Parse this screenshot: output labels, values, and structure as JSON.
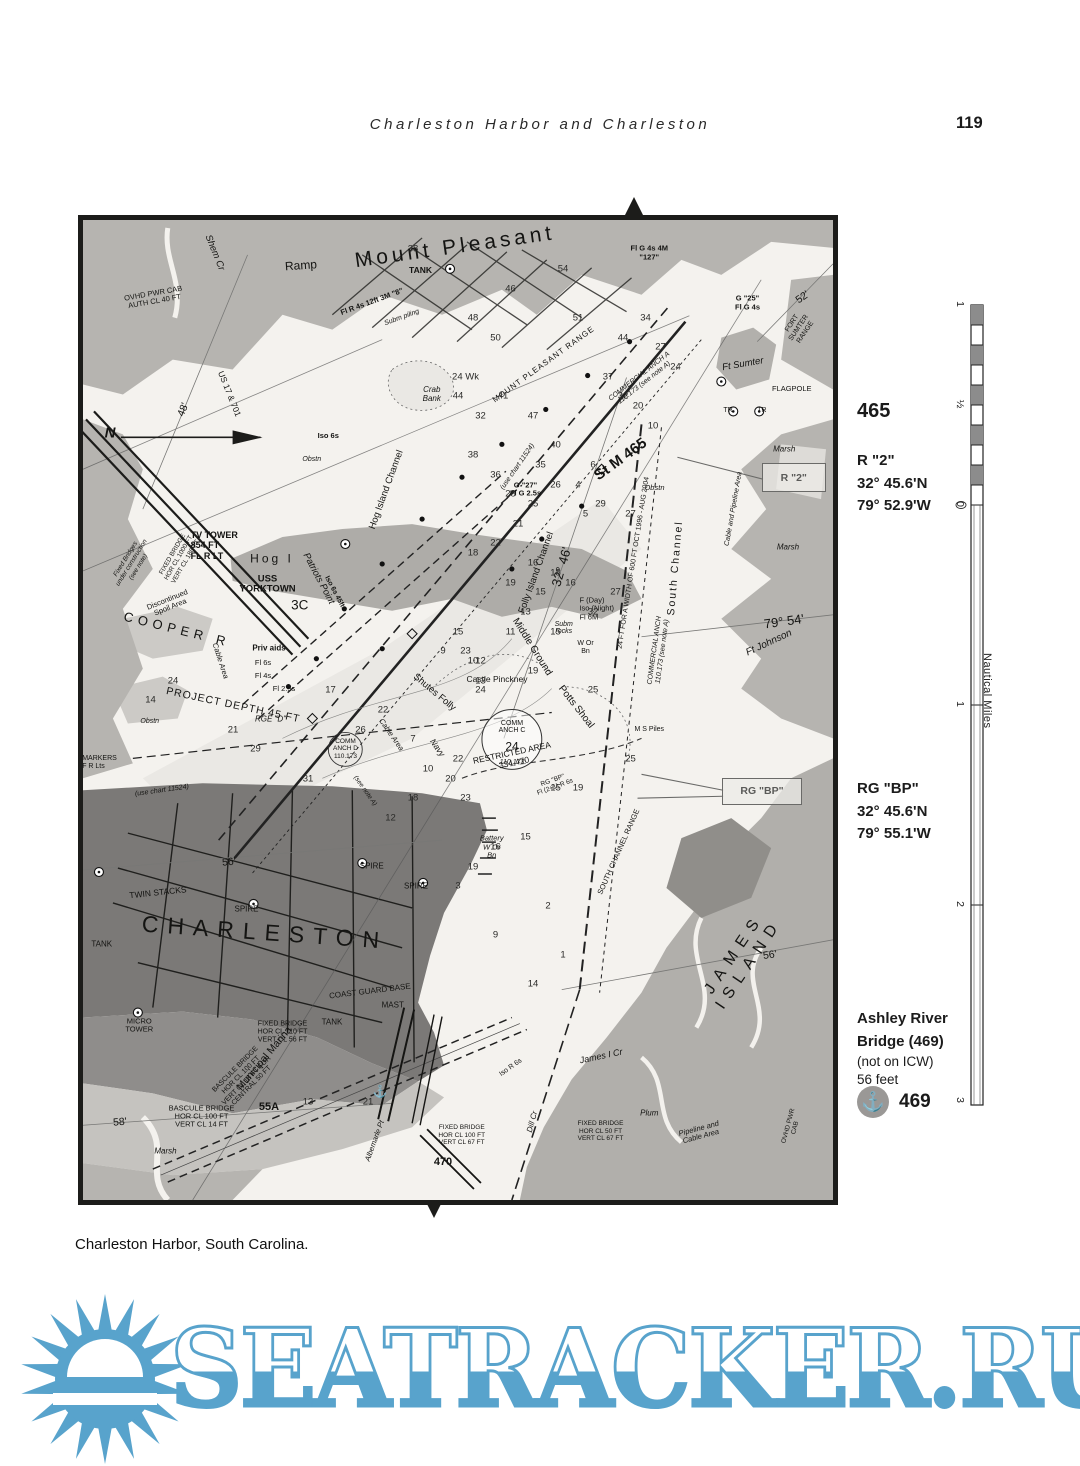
{
  "page": {
    "header_title": "Charleston Harbor and Charleston",
    "page_number": "119",
    "caption": "Charleston Harbor, South Carolina."
  },
  "sidebar": {
    "mile_number": "465",
    "r2": {
      "name": "R \"2\"",
      "lat": "32° 45.6'N",
      "lon": "79° 52.9'W"
    },
    "rgbp": {
      "name": "RG \"BP\"",
      "lat": "32° 45.6'N",
      "lon": "79° 55.1'W"
    },
    "bridge": {
      "line1": "Ashley River",
      "line2": "Bridge (469)",
      "note": "(not on ICW)",
      "height": "56 feet",
      "anchor_number": "469",
      "anchor_icon": "⚓"
    },
    "scale": {
      "title": "Nautical Miles",
      "ticks": [
        {
          "label": "1",
          "y": 10
        },
        {
          "label": "½",
          "y": 110
        },
        {
          "label": "0",
          "y": 210
        },
        {
          "label": "1",
          "y": 410
        },
        {
          "label": "2",
          "y": 610
        },
        {
          "label": "3",
          "y": 806
        }
      ]
    }
  },
  "map": {
    "callouts": [
      {
        "text": "R \"2\""
      },
      {
        "text": "RG \"BP\""
      }
    ],
    "labels": [
      {
        "t": "Mount Pleasant",
        "x": 49.6,
        "y": 2.8,
        "r": -8,
        "s": 21,
        "sp": 4,
        "w": 500,
        "n": "label-mount-pleasant"
      },
      {
        "t": "Ramp",
        "x": 29,
        "y": 4.7,
        "s": 12,
        "r": -4
      },
      {
        "t": "TANK",
        "x": 45,
        "y": 5.2,
        "s": 8.5,
        "w": 600
      },
      {
        "t": "Shem Cr",
        "x": 17.5,
        "y": 3.4,
        "r": 68,
        "s": 9.5,
        "i": 1
      },
      {
        "t": "OVHD PWR CAB\nAUTH CL 40 FT",
        "x": 9.5,
        "y": 8,
        "r": -10,
        "s": 7.5
      },
      {
        "t": "Fl R 4s 12ft 3M \"8\"",
        "x": 38.6,
        "y": 8.4,
        "r": -20,
        "s": 7.5,
        "w": 600
      },
      {
        "t": "Subm piling",
        "x": 42.5,
        "y": 10,
        "r": -20,
        "s": 7,
        "i": 1
      },
      {
        "t": "Fl G 4s 4M\n\"127\"",
        "x": 75.5,
        "y": 3.4,
        "s": 7.5,
        "w": 600
      },
      {
        "t": "52'",
        "x": 96,
        "y": 8,
        "r": -35,
        "s": 10.5
      },
      {
        "t": "G \"25\"\nFl G 4s",
        "x": 88.6,
        "y": 8.5,
        "s": 7.5,
        "w": 600
      },
      {
        "t": "MOUNT PLEASANT RANGE",
        "x": 61.5,
        "y": 14.8,
        "r": -36,
        "s": 8,
        "sp": 1
      },
      {
        "t": "COMMERCIAL ANCH A\n110.173 (see note A)",
        "x": 74.5,
        "y": 16.3,
        "r": -38,
        "s": 7,
        "i": 1
      },
      {
        "t": "FORT SUMTER RANGE",
        "x": 95.5,
        "y": 11,
        "r": -56,
        "s": 7
      },
      {
        "t": "Ft Sumter",
        "x": 88,
        "y": 14.8,
        "r": -10,
        "s": 9.5,
        "i": 1
      },
      {
        "t": "FLAGPOLE",
        "x": 94.5,
        "y": 17.2,
        "s": 7.5
      },
      {
        "t": "TR",
        "x": 86,
        "y": 19.5,
        "s": 7
      },
      {
        "t": "TR",
        "x": 90.5,
        "y": 19.5,
        "s": 7
      },
      {
        "t": "Crab\nBank",
        "x": 46.5,
        "y": 17.9,
        "s": 8,
        "i": 1
      },
      {
        "t": "48'",
        "x": 13.4,
        "y": 19.4,
        "r": -68,
        "s": 10.5
      },
      {
        "t": "N",
        "x": 3.6,
        "y": 21.8,
        "s": 15,
        "w": 700,
        "i": 1
      },
      {
        "t": "US 17 & 701",
        "x": 19.5,
        "y": 17.8,
        "r": 68,
        "s": 8.5
      },
      {
        "t": "Iso 6s",
        "x": 32.7,
        "y": 22,
        "s": 7.5,
        "w": 600
      },
      {
        "t": "Obstn",
        "x": 30.5,
        "y": 24.5,
        "s": 7,
        "i": 1
      },
      {
        "t": "(use chart 11524)",
        "x": 58,
        "y": 25.2,
        "r": -55,
        "s": 7,
        "i": 1
      },
      {
        "t": "St M 465",
        "x": 71.7,
        "y": 24.5,
        "r": -36,
        "s": 15,
        "w": 700,
        "n": "label-st-m-465"
      },
      {
        "t": "G \"27\"\nFl G 2.5s",
        "x": 59,
        "y": 27.5,
        "s": 7.5,
        "w": 600
      },
      {
        "t": "Obstn",
        "x": 76.2,
        "y": 27.3,
        "s": 7.5,
        "i": 1
      },
      {
        "t": "TV TOWER\n854 FT\nFL R LT",
        "x": 17.5,
        "y": 33.2,
        "s": 9,
        "w": 600,
        "a": "left"
      },
      {
        "t": "Fixed Bridges\nunder construction\n(see note)",
        "x": 6.5,
        "y": 35,
        "r": -58,
        "s": 6.5,
        "i": 1
      },
      {
        "t": "FIXED BRIDGE\nHOR CL 1000 FT\nVERT CL 186 FT",
        "x": 12.8,
        "y": 34.5,
        "r": -60,
        "s": 6.5
      },
      {
        "t": "Hog I",
        "x": 25.2,
        "y": 34.6,
        "s": 12,
        "sp": 3
      },
      {
        "t": "Patriots Point",
        "x": 31.3,
        "y": 36.6,
        "r": 62,
        "s": 9.5,
        "i": 1
      },
      {
        "t": "Iso 6s 45ft",
        "x": 33.5,
        "y": 38,
        "r": 62,
        "s": 7,
        "w": 600
      },
      {
        "t": "USS\nYORKTOWN",
        "x": 24.6,
        "y": 37.2,
        "s": 9.5,
        "w": 600
      },
      {
        "t": "3C",
        "x": 28.9,
        "y": 39.3,
        "s": 13.5
      },
      {
        "t": "32° 46'",
        "x": 63.8,
        "y": 35.4,
        "r": -74,
        "s": 13
      },
      {
        "t": "Folly Island Channel",
        "x": 60.5,
        "y": 36,
        "r": -70,
        "s": 9.5
      },
      {
        "t": "Hog Island Channel",
        "x": 40.5,
        "y": 27.5,
        "r": -70,
        "s": 9.5
      },
      {
        "t": "South Channel",
        "x": 79,
        "y": 35.5,
        "r": -85,
        "s": 10.5,
        "sp": 2
      },
      {
        "t": "24 FT FOR A WIDTH OF 600 FT OCT 1996 - AUG 2004",
        "x": 73.5,
        "y": 35,
        "r": -81,
        "s": 7
      },
      {
        "t": "COMMERCIAL ANCH\n110.173 (see note A)",
        "x": 76.8,
        "y": 44,
        "r": -82,
        "s": 7,
        "i": 1
      },
      {
        "t": "Cable and Pipeline Area",
        "x": 86.8,
        "y": 29.5,
        "r": -80,
        "s": 7,
        "i": 1
      },
      {
        "t": "Marsh",
        "x": 93.5,
        "y": 23.5,
        "s": 8,
        "i": 1
      },
      {
        "t": "Marsh",
        "x": 94,
        "y": 33.5,
        "s": 8,
        "i": 1
      },
      {
        "t": "79° 54'",
        "x": 93.5,
        "y": 41,
        "r": -8,
        "s": 13
      },
      {
        "t": "Ft Johnson",
        "x": 91.5,
        "y": 43.2,
        "r": -25,
        "s": 10,
        "i": 1
      },
      {
        "t": "COOPER R",
        "x": 12.5,
        "y": 41.8,
        "r": 14,
        "s": 13,
        "sp": 5,
        "n": "label-cooper-river"
      },
      {
        "t": "Discontinued\nSpoil Area",
        "x": 11.5,
        "y": 39.2,
        "r": -22,
        "s": 7.5
      },
      {
        "t": "Priv aids",
        "x": 24.8,
        "y": 43.8,
        "s": 8,
        "w": 600
      },
      {
        "t": "Fl 6s",
        "x": 24,
        "y": 45.2,
        "s": 7.5
      },
      {
        "t": "Fl 4s",
        "x": 24,
        "y": 46.5,
        "s": 7.5
      },
      {
        "t": "Fl 2.5s",
        "x": 26.8,
        "y": 47.9,
        "s": 7.5
      },
      {
        "t": "Cable Area",
        "x": 18.2,
        "y": 45,
        "r": 72,
        "s": 7.5,
        "i": 1
      },
      {
        "t": "PROJECT DEPTH 45 FT",
        "x": 20,
        "y": 49.6,
        "r": 12,
        "s": 10.5,
        "sp": 1
      },
      {
        "t": "RGE \"D\"",
        "x": 25,
        "y": 51,
        "s": 8,
        "i": 1
      },
      {
        "t": "Cable Area",
        "x": 41,
        "y": 52.5,
        "r": 55,
        "s": 7.5,
        "i": 1
      },
      {
        "t": "(use chart 11524)",
        "x": 10.5,
        "y": 58.3,
        "r": -8,
        "s": 7,
        "i": 1
      },
      {
        "t": "MARKERS\nF R Lts",
        "x": 2.2,
        "y": 55.4,
        "s": 7,
        "a": "left"
      },
      {
        "t": "Obstn",
        "x": 8.9,
        "y": 51.2,
        "s": 7,
        "i": 1
      },
      {
        "t": "Shutes Folly",
        "x": 46.8,
        "y": 48.3,
        "r": 40,
        "s": 9.5
      },
      {
        "t": "Castle Pinckney",
        "x": 55.2,
        "y": 46.9,
        "s": 8.5
      },
      {
        "t": "Middle Ground",
        "x": 59.8,
        "y": 43.6,
        "r": 58,
        "s": 10
      },
      {
        "t": "Subm\nrocks",
        "x": 64.1,
        "y": 41.7,
        "s": 7,
        "i": 1
      },
      {
        "t": "F (Day)\nIso (Night)\nFl 6M",
        "x": 68.5,
        "y": 39.7,
        "s": 7.5,
        "a": "left"
      },
      {
        "t": "W Or\nBn",
        "x": 67,
        "y": 43.7,
        "s": 7
      },
      {
        "t": "Potts Shoal",
        "x": 65.7,
        "y": 49.7,
        "r": 52,
        "s": 10
      },
      {
        "t": "COMM\nANCH C",
        "x": 57.2,
        "y": 51.8,
        "s": 7
      },
      {
        "t": "24",
        "x": 57.2,
        "y": 53.8,
        "s": 12
      },
      {
        "t": "110.173",
        "x": 57.2,
        "y": 55.4,
        "s": 7,
        "i": 1
      },
      {
        "t": "COMM\nANCH D\n110.173",
        "x": 35,
        "y": 54,
        "s": 6.5
      },
      {
        "t": "(see note A)",
        "x": 37.6,
        "y": 58.3,
        "r": 55,
        "s": 6.5,
        "i": 1
      },
      {
        "t": "Navy",
        "x": 47.2,
        "y": 53.9,
        "r": 55,
        "s": 8.5,
        "i": 1
      },
      {
        "t": "RESTRICTED AREA\n334.470",
        "x": 57.3,
        "y": 54.9,
        "r": -12,
        "s": 8.5
      },
      {
        "t": "RG \"BP\"\nFl (2+1) R 6s",
        "x": 62.8,
        "y": 57.6,
        "r": -20,
        "s": 6.5
      },
      {
        "t": "M S Piles",
        "x": 75.5,
        "y": 52,
        "s": 7
      },
      {
        "t": "SOUTH CHANNEL RANGE",
        "x": 71.5,
        "y": 64.5,
        "r": -66,
        "s": 7.5
      },
      {
        "t": "Battery\nW Or\nBn",
        "x": 54.5,
        "y": 64,
        "s": 7.5,
        "i": 1
      },
      {
        "t": "56'",
        "x": 19.5,
        "y": 65.6,
        "r": -5,
        "s": 10.5
      },
      {
        "t": "TWIN STACKS",
        "x": 10,
        "y": 68.7,
        "r": -6,
        "s": 8.5
      },
      {
        "t": "SPIRE",
        "x": 21.8,
        "y": 70.4,
        "s": 8
      },
      {
        "t": "SPIRE",
        "x": 38.5,
        "y": 66,
        "s": 8
      },
      {
        "t": "SPIRE",
        "x": 44.4,
        "y": 68.1,
        "s": 8
      },
      {
        "t": "CHARLESTON",
        "x": 24.2,
        "y": 72.8,
        "r": 4,
        "s": 23,
        "sp": 9,
        "n": "label-charleston"
      },
      {
        "t": "TANK",
        "x": 2.5,
        "y": 74,
        "s": 8
      },
      {
        "t": "COAST GUARD BASE",
        "x": 38.2,
        "y": 78.8,
        "r": -7,
        "s": 8
      },
      {
        "t": "MAST",
        "x": 41.3,
        "y": 80.2,
        "s": 8
      },
      {
        "t": "JAMES ISLAND",
        "x": 87.8,
        "y": 75.4,
        "r": -56,
        "s": 16,
        "sp": 8,
        "n": "label-james-island"
      },
      {
        "t": "56'",
        "x": 91.6,
        "y": 75.1,
        "r": -8,
        "s": 10.5
      },
      {
        "t": "James I Cr",
        "x": 69,
        "y": 85.3,
        "r": -12,
        "s": 9,
        "i": 1
      },
      {
        "t": "Plum",
        "x": 75.5,
        "y": 91.2,
        "s": 8,
        "i": 1
      },
      {
        "t": "Dill Cr",
        "x": 60,
        "y": 92,
        "r": -75,
        "s": 8,
        "i": 1
      },
      {
        "t": "Pipeline and\nCable Area",
        "x": 82.3,
        "y": 93.2,
        "r": -15,
        "s": 7.5,
        "i": 1
      },
      {
        "t": "FIXED BRIDGE\nHOR CL 50 FT\nVERT CL 67 FT",
        "x": 69,
        "y": 93,
        "s": 6.5
      },
      {
        "t": "FIXED BRIDGE\nHOR CL 100 FT\nVERT CL 67 FT",
        "x": 50.5,
        "y": 93.4,
        "s": 6.5
      },
      {
        "t": "MICRO\nTOWER",
        "x": 7.5,
        "y": 82.2,
        "s": 7.5
      },
      {
        "t": "TANK",
        "x": 33.2,
        "y": 81.9,
        "s": 8
      },
      {
        "t": "Municipal Marina",
        "x": 24.3,
        "y": 85.6,
        "r": -50,
        "s": 10.5
      },
      {
        "t": "FIXED BRIDGE\nHOR CL 110 FT\nVERT CL 56 FT",
        "x": 26.6,
        "y": 82.9,
        "s": 7
      },
      {
        "t": "BASCULE BRIDGE\nHOR CL 100 FT\nVERT CL 18 FT FOR\nCENTRAL 50 FT",
        "x": 21.5,
        "y": 87.6,
        "r": -45,
        "s": 7
      },
      {
        "t": "BASCULE BRIDGE\nHOR CL 100 FT\nVERT CL 14 FT",
        "x": 15.8,
        "y": 91.5,
        "s": 7.5
      },
      {
        "t": "55A",
        "x": 24.8,
        "y": 90.5,
        "s": 11,
        "w": 700,
        "n": "label-bridge-55a"
      },
      {
        "t": "470",
        "x": 48,
        "y": 96.1,
        "s": 11,
        "w": 700,
        "n": "label-bridge-470"
      },
      {
        "t": "Marsh",
        "x": 11,
        "y": 95.1,
        "s": 8,
        "i": 1
      },
      {
        "t": "58'",
        "x": 4.9,
        "y": 92.1,
        "r": -5,
        "s": 10.5
      },
      {
        "t": "Albemarle Pt",
        "x": 38.9,
        "y": 94,
        "r": -70,
        "s": 7.5,
        "i": 1
      },
      {
        "t": "Iso R 6s",
        "x": 57,
        "y": 86.5,
        "r": -35,
        "s": 7
      },
      {
        "t": "⚓",
        "x": 39.6,
        "y": 89,
        "s": 12,
        "n": "anchorage-icon"
      },
      {
        "t": "OVHD PWR CAB",
        "x": 94.5,
        "y": 92.5,
        "r": -75,
        "s": 6.5
      }
    ],
    "depths": [
      [
        "38",
        44,
        3
      ],
      [
        "54",
        64,
        5
      ],
      [
        "46",
        57,
        7
      ],
      [
        "48",
        52,
        10
      ],
      [
        "50",
        55,
        12
      ],
      [
        "51",
        66,
        10
      ],
      [
        "34",
        75,
        10
      ],
      [
        "27",
        77,
        13
      ],
      [
        "24",
        79,
        15
      ],
      [
        "44",
        72,
        12
      ],
      [
        "37",
        70,
        16
      ],
      [
        "32",
        72,
        18
      ],
      [
        "20",
        74,
        19
      ],
      [
        "10",
        76,
        21
      ],
      [
        "41",
        56,
        18
      ],
      [
        "47",
        60,
        20
      ],
      [
        "24 Wk",
        51,
        16
      ],
      [
        "44",
        50,
        18
      ],
      [
        "32",
        53,
        20
      ],
      [
        "38",
        52,
        24
      ],
      [
        "40",
        63,
        23
      ],
      [
        "35",
        61,
        25
      ],
      [
        "36",
        55,
        26
      ],
      [
        "28",
        57,
        28
      ],
      [
        "25",
        60,
        29
      ],
      [
        "26",
        63,
        27
      ],
      [
        "29",
        69,
        29
      ],
      [
        "27",
        73,
        30
      ],
      [
        "21",
        58,
        31
      ],
      [
        "22",
        55,
        33
      ],
      [
        "18",
        52,
        34
      ],
      [
        "16",
        60,
        35
      ],
      [
        "19",
        57,
        37
      ],
      [
        "15",
        61,
        38
      ],
      [
        "13",
        59,
        40
      ],
      [
        "11",
        57,
        42
      ],
      [
        "15",
        63,
        42
      ],
      [
        "16",
        65,
        37
      ],
      [
        "18",
        63,
        36
      ],
      [
        "23",
        51,
        44
      ],
      [
        "12",
        53,
        45
      ],
      [
        "9",
        48,
        44
      ],
      [
        "14",
        9,
        49
      ],
      [
        "24",
        12,
        47
      ],
      [
        "21",
        20,
        52
      ],
      [
        "29",
        23,
        54
      ],
      [
        "17",
        33,
        48
      ],
      [
        "22",
        40,
        50
      ],
      [
        "26",
        37,
        52
      ],
      [
        "31",
        30,
        57
      ],
      [
        "15",
        50,
        42
      ],
      [
        "10",
        52,
        45
      ],
      [
        "13",
        53,
        47
      ],
      [
        "24",
        53,
        48
      ],
      [
        "19",
        60,
        46
      ],
      [
        "7",
        44,
        53
      ],
      [
        "10",
        46,
        56
      ],
      [
        "20",
        49,
        57
      ],
      [
        "23",
        51,
        59
      ],
      [
        "22",
        50,
        55
      ],
      [
        "18",
        44,
        59
      ],
      [
        "12",
        41,
        61
      ],
      [
        "16",
        55,
        64
      ],
      [
        "19",
        52,
        66
      ],
      [
        "15",
        59,
        63
      ],
      [
        "14",
        60,
        78
      ],
      [
        "9",
        55,
        73
      ],
      [
        "2",
        62,
        70
      ],
      [
        "1",
        64,
        75
      ],
      [
        "4",
        66,
        27
      ],
      [
        "6",
        68,
        25
      ],
      [
        "5",
        67,
        30
      ],
      [
        "13",
        30,
        90
      ],
      [
        "21",
        38,
        90
      ],
      [
        "3",
        50,
        68
      ],
      [
        "25",
        68,
        48
      ],
      [
        "25",
        73,
        55
      ],
      [
        "19",
        66,
        58
      ],
      [
        "15",
        63,
        58
      ],
      [
        "32",
        68,
        40
      ],
      [
        "27",
        71,
        38
      ]
    ]
  },
  "watermark": {
    "text": "SEATRACKER.RU",
    "color": "#58a3cc"
  }
}
